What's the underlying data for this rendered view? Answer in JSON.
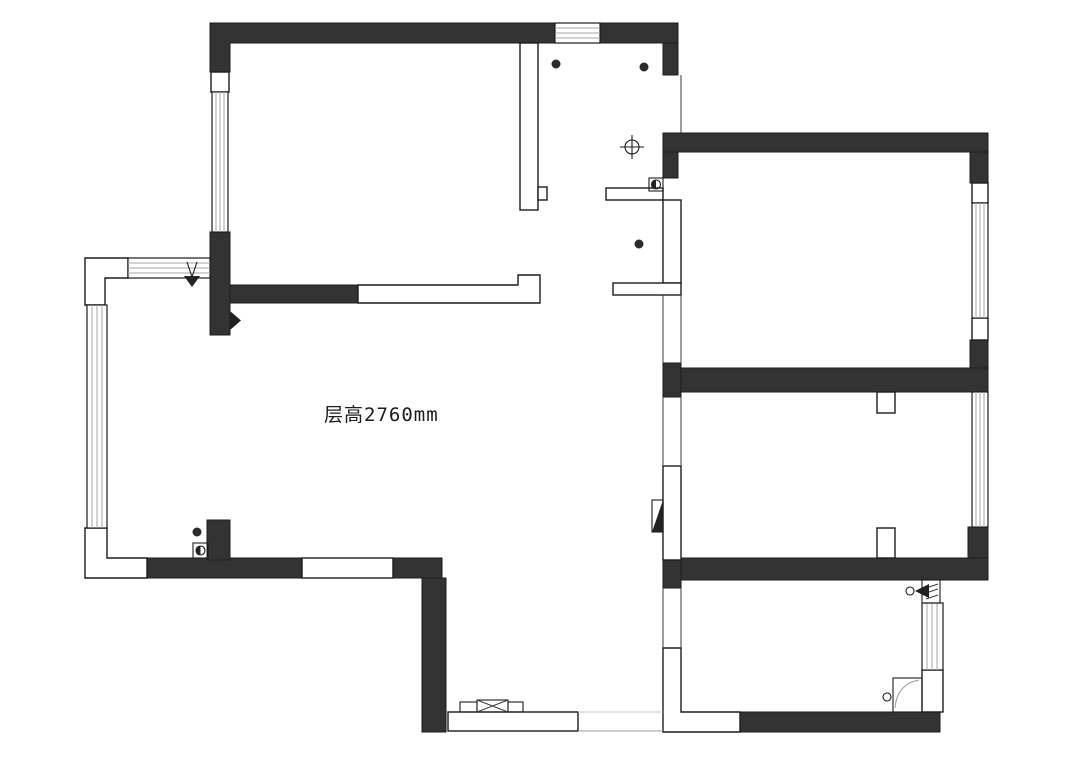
{
  "labels": {
    "floor_height": "层高2760mm"
  },
  "colors": {
    "wall": "#333333",
    "line": "#1c1c1c",
    "hatch": "#a6a6a6",
    "bg": "#ffffff",
    "text": "#1c1c1c"
  },
  "icons": [
    {
      "name": "entry-direction-arrow",
      "glyph": "▼"
    },
    {
      "name": "light-fixture-crosshair",
      "glyph": "⊕"
    },
    {
      "name": "junction-box-half-circle",
      "glyph": "◑"
    },
    {
      "name": "door-swing-triangle-right",
      "glyph": "▶"
    },
    {
      "name": "door-swing-triangle-left",
      "glyph": "◀"
    },
    {
      "name": "point-marker-dot",
      "glyph": "●"
    }
  ]
}
